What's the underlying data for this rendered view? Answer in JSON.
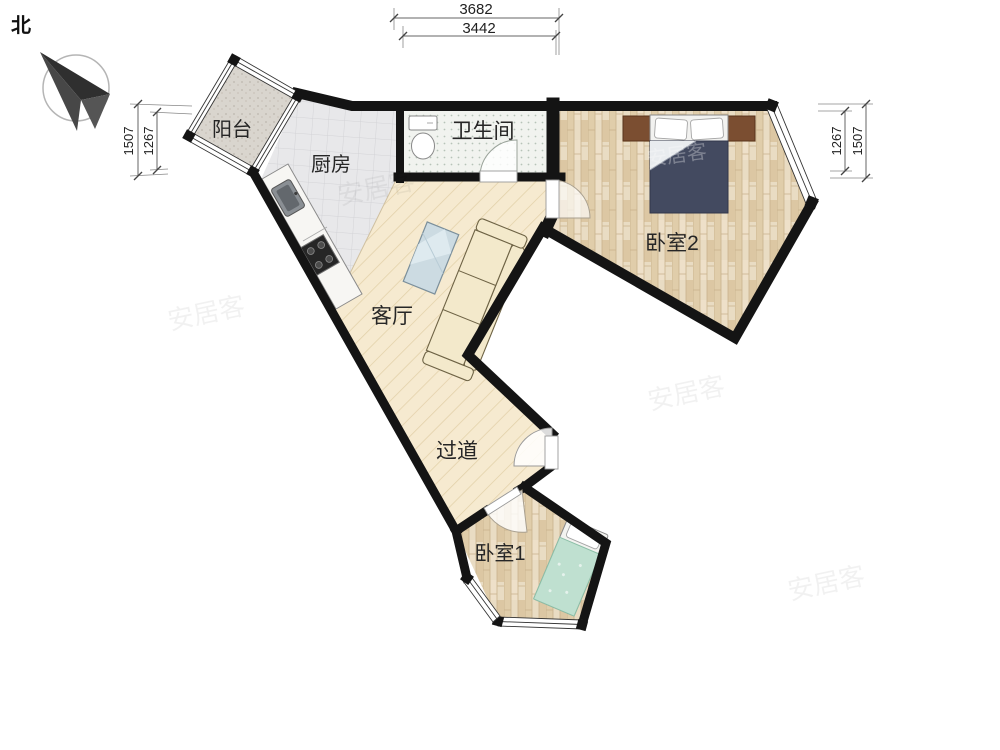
{
  "compass": {
    "label": "北"
  },
  "rooms": {
    "balcony": {
      "label": "阳台"
    },
    "kitchen": {
      "label": "厨房"
    },
    "bathroom": {
      "label": "卫生间"
    },
    "bedroom2": {
      "label": "卧室2"
    },
    "living_room": {
      "label": "客厅"
    },
    "hallway": {
      "label": "过道"
    },
    "bedroom1": {
      "label": "卧室1"
    }
  },
  "dimensions": {
    "top_outer": "3682",
    "top_inner": "3442",
    "left_outer": "1507",
    "left_inner": "1267",
    "right_inner": "1267",
    "right_outer": "1507"
  },
  "watermark": {
    "text": "安居客"
  },
  "colors": {
    "wall": "#141414",
    "wood_diagonal_floor": "#f6ead0",
    "plank_floor": "#e9dcc3",
    "kitchen_tile": "#e8e8ea",
    "bathroom_tile": "#f1f3ef",
    "balcony_floor": "#d9d5ce",
    "bed2_blanket": "#434a60",
    "bed1_blanket": "#bfe0d0",
    "nightstand": "#7b4e31",
    "sofa": "#f3e9cb",
    "coffee_table": "#ccdbe2"
  }
}
